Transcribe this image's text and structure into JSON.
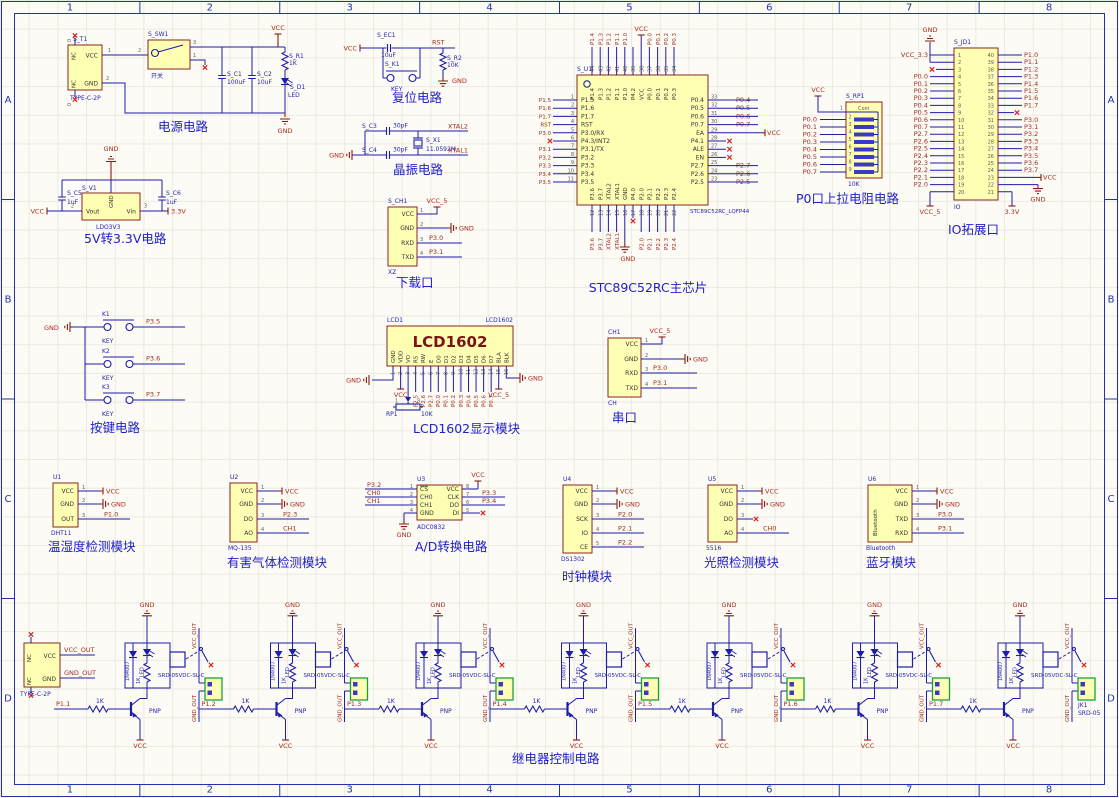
{
  "sheet": {
    "zone_columns": [
      "1",
      "2",
      "3",
      "4",
      "5",
      "6",
      "7",
      "8"
    ],
    "zone_rows": [
      "A",
      "B",
      "C",
      "D"
    ],
    "colors": {
      "component_fill": "#FFFFB4",
      "component_border": "#7A1010",
      "wire": "#1D1DA8",
      "net_label": "#9E2A20",
      "power_label": "#A82A1E",
      "annotation_blue": "#1F1FB0",
      "title_blue": "#2020CC",
      "terminal_green": "#18A038",
      "nc_red": "#E02020",
      "background": "#FCFBF5"
    }
  },
  "blocks": {
    "power": {
      "title": "电源电路",
      "t1": {
        "refdes": "S_T1",
        "value": "TYPE-C-2P",
        "pin_vcc": "VCC",
        "pin_gnd": "GND",
        "pin_nc": "NC",
        "num_vcc": "1",
        "num_gnd": "2",
        "nc_num": "0"
      },
      "sw": {
        "refdes": "S_SW1",
        "value": "开关",
        "num_in": "2",
        "num_out": "3",
        "num_nc": "1"
      },
      "c1": {
        "refdes": "S_C1",
        "value": "100uF"
      },
      "c2": {
        "refdes": "S_C2",
        "value": "10uF"
      },
      "r1": {
        "refdes": "S_R1",
        "value": "1K"
      },
      "d1": {
        "refdes": "S_D1",
        "value": "LED"
      },
      "vcc": "VCC",
      "gnd": "GND"
    },
    "reset": {
      "title": "复位电路",
      "vcc": "VCC",
      "rst": "RST",
      "gnd": "GND",
      "ec1": {
        "refdes": "S_EC1",
        "value": "10uF"
      },
      "k1": {
        "refdes": "S_K1",
        "value": "KEY"
      },
      "r2": {
        "refdes": "S_R2",
        "value": "10K"
      }
    },
    "crystal": {
      "title": "晶振电路",
      "gnd": "GND",
      "xtal2": "XTAL2",
      "xtal1": "XTAL1",
      "c3": {
        "refdes": "S_C3",
        "value": "30pF"
      },
      "c4": {
        "refdes": "S_C4",
        "value": "30pF"
      },
      "x1": {
        "refdes": "S_X1",
        "value": "11.0592M"
      }
    },
    "ldo": {
      "title": "5V转3.3V电路",
      "vcc": "VCC",
      "gnd": "GND",
      "v33": "3.3V",
      "v1": {
        "refdes": "S_V1",
        "value": "LDO3V3",
        "pin_out": "Vout",
        "pin_gnd": "GND",
        "pin_in": "Vin",
        "num_out": "2",
        "num_in": "3"
      },
      "c5": {
        "refdes": "S_C5",
        "value": "1uF"
      },
      "c6": {
        "refdes": "S_C6",
        "value": "1uF"
      }
    },
    "download": {
      "title": "下载口",
      "refdes": "S_CH1",
      "value": "XZ",
      "pins": [
        {
          "name": "VCC",
          "num": "1",
          "net": "VCC_5"
        },
        {
          "name": "GND",
          "num": "2",
          "net": "GND"
        },
        {
          "name": "RXD",
          "num": "3",
          "net": "P3.0"
        },
        {
          "name": "TXD",
          "num": "4",
          "net": "P3.1"
        }
      ]
    },
    "serial": {
      "title": "串口",
      "refdes": "CH1",
      "value": "CH",
      "pins": [
        {
          "name": "VCC",
          "num": "1",
          "net": "VCC_5"
        },
        {
          "name": "GND",
          "num": "2",
          "net": "GND"
        },
        {
          "name": "RXD",
          "num": "3",
          "net": "P3.0"
        },
        {
          "name": "TXD",
          "num": "4",
          "net": "P3.1"
        }
      ]
    },
    "mcu": {
      "title": "STC89C52RC主芯片",
      "refdes": "S_U1",
      "value": "STC89C52RC_LQFP44",
      "gnd": "GND",
      "vcc": "VCC",
      "top_pins": [
        {
          "num": "44",
          "name": "P1.4",
          "net": "P1.4"
        },
        {
          "num": "43",
          "name": "P1.3",
          "net": "P1.3"
        },
        {
          "num": "42",
          "name": "P1.2",
          "net": "P1.2"
        },
        {
          "num": "41",
          "name": "P1.1",
          "net": "P1.1"
        },
        {
          "num": "40",
          "name": "P1.0",
          "net": "P1.0"
        },
        {
          "num": "39",
          "name": "P4.2",
          "net": ""
        },
        {
          "num": "38",
          "name": "VCC",
          "net": "VCC"
        },
        {
          "num": "37",
          "name": "P0.0",
          "net": "P0.0"
        },
        {
          "num": "36",
          "name": "P0.1",
          "net": "P0.1"
        },
        {
          "num": "35",
          "name": "P0.2",
          "net": "P0.2"
        },
        {
          "num": "34",
          "name": "P0.3",
          "net": "P0.3"
        }
      ],
      "left_pins": [
        {
          "num": "1",
          "name": "P1.5",
          "net": "P1.5"
        },
        {
          "num": "2",
          "name": "P1.6",
          "net": "P1.6"
        },
        {
          "num": "3",
          "name": "P1.7",
          "net": "P1.7"
        },
        {
          "num": "4",
          "name": "RST",
          "net": "RST"
        },
        {
          "num": "5",
          "name": "P3.0/RX",
          "net": "P3.0"
        },
        {
          "num": "6",
          "name": "P4.3/INT2",
          "net": ""
        },
        {
          "num": "7",
          "name": "P3.1/TX",
          "net": "P3.1"
        },
        {
          "num": "8",
          "name": "P3.2",
          "net": "P3.2"
        },
        {
          "num": "9",
          "name": "P3.3",
          "net": "P3.3"
        },
        {
          "num": "10",
          "name": "P3.4",
          "net": "P3.4"
        },
        {
          "num": "11",
          "name": "P3.5",
          "net": "P3.5"
        }
      ],
      "right_pins": [
        {
          "num": "33",
          "name": "P0.4",
          "net": "P0.4"
        },
        {
          "num": "32",
          "name": "P0.5",
          "net": "P0.5"
        },
        {
          "num": "31",
          "name": "P0.6",
          "net": "P0.6"
        },
        {
          "num": "30",
          "name": "P0.7",
          "net": "P0.7"
        },
        {
          "num": "29",
          "name": "EA",
          "net": "VCC"
        },
        {
          "num": "28",
          "name": "P4.1",
          "net": ""
        },
        {
          "num": "27",
          "name": "ALE",
          "net": ""
        },
        {
          "num": "26",
          "name": "EN",
          "net": ""
        },
        {
          "num": "25",
          "name": "P2.7",
          "net": "P2.7"
        },
        {
          "num": "24",
          "name": "P2.6",
          "net": "P2.6"
        },
        {
          "num": "23",
          "name": "P2.5",
          "net": "P2.5"
        }
      ],
      "bottom_pins": [
        {
          "num": "12",
          "name": "P3.6",
          "net": "P3.6"
        },
        {
          "num": "13",
          "name": "P3.7",
          "net": "P3.7"
        },
        {
          "num": "14",
          "name": "XTAL2",
          "net": "XTAL2"
        },
        {
          "num": "15",
          "name": "XTAL1",
          "net": "XTAL1"
        },
        {
          "num": "16",
          "name": "GND",
          "net": "GND"
        },
        {
          "num": "17",
          "name": "P4.0",
          "net": ""
        },
        {
          "num": "18",
          "name": "P2.0",
          "net": "P2.0"
        },
        {
          "num": "19",
          "name": "P2.1",
          "net": "P2.1"
        },
        {
          "num": "20",
          "name": "P2.2",
          "net": "P2.2"
        },
        {
          "num": "21",
          "name": "P2.3",
          "net": "P2.3"
        },
        {
          "num": "22",
          "name": "P2.4",
          "net": "P2.4"
        }
      ]
    },
    "pullup": {
      "title": "P0口上拉电阻电路",
      "refdes": "S_RP1",
      "value": "10K",
      "com": "Com",
      "vcc": "VCC",
      "nums": [
        "1",
        "2",
        "3",
        "4",
        "5",
        "6",
        "7",
        "8",
        "9"
      ],
      "nets": [
        "P0.0",
        "P0.1",
        "P0.2",
        "P0.3",
        "P0.4",
        "P0.5",
        "P0.6",
        "P0.7"
      ]
    },
    "io": {
      "title": "IO拓展口",
      "refdes": "S_JD1",
      "value": "IO",
      "left": [
        {
          "num": "1",
          "net": "VCC_3.3"
        },
        {
          "num": "2",
          "net": "GND"
        },
        {
          "num": "3",
          "net": ""
        },
        {
          "num": "4",
          "net": "P0.0"
        },
        {
          "num": "5",
          "net": "P0.1"
        },
        {
          "num": "6",
          "net": "P0.2"
        },
        {
          "num": "7",
          "net": "P0.3"
        },
        {
          "num": "8",
          "net": "P0.4"
        },
        {
          "num": "9",
          "net": "P0.5"
        },
        {
          "num": "10",
          "net": "P0.6"
        },
        {
          "num": "11",
          "net": "P0.7"
        },
        {
          "num": "12",
          "net": "P2.7"
        },
        {
          "num": "13",
          "net": "P2.6"
        },
        {
          "num": "14",
          "net": "P2.5"
        },
        {
          "num": "15",
          "net": "P2.4"
        },
        {
          "num": "16",
          "net": "P2.3"
        },
        {
          "num": "17",
          "net": "P2.2"
        },
        {
          "num": "18",
          "net": "P2.1"
        },
        {
          "num": "19",
          "net": "P2.0"
        },
        {
          "num": "20",
          "net": "VCC_5"
        }
      ],
      "right": [
        {
          "num": "40",
          "net": "P1.0"
        },
        {
          "num": "39",
          "net": "P1.1"
        },
        {
          "num": "38",
          "net": "P1.2"
        },
        {
          "num": "37",
          "net": "P1.3"
        },
        {
          "num": "36",
          "net": "P1.4"
        },
        {
          "num": "35",
          "net": "P1.5"
        },
        {
          "num": "34",
          "net": "P1.6"
        },
        {
          "num": "33",
          "net": "P1.7"
        },
        {
          "num": "32",
          "net": ""
        },
        {
          "num": "31",
          "net": "P3.0"
        },
        {
          "num": "30",
          "net": "P3.1"
        },
        {
          "num": "29",
          "net": "P3.2"
        },
        {
          "num": "28",
          "net": "P3.3"
        },
        {
          "num": "27",
          "net": "P3.4"
        },
        {
          "num": "26",
          "net": "P3.5"
        },
        {
          "num": "25",
          "net": "P3.6"
        },
        {
          "num": "24",
          "net": "P3.7"
        },
        {
          "num": "23",
          "net": "VCC"
        },
        {
          "num": "22",
          "net": "GND"
        },
        {
          "num": "21",
          "net": "3.3V"
        }
      ]
    },
    "keys": {
      "title": "按键电路",
      "gnd": "GND",
      "items": [
        {
          "refdes": "K1",
          "value": "KEY",
          "net": "P3.5"
        },
        {
          "refdes": "K2",
          "value": "KEY",
          "net": "P3.6"
        },
        {
          "refdes": "K3",
          "value": "KEY",
          "net": "P3.7"
        }
      ]
    },
    "lcd": {
      "title": "LCD1602显示模块",
      "refdes": "LCD1",
      "value": "LCD1602",
      "display": "LCD1602",
      "pins": [
        "GND",
        "VDD",
        "VO",
        "RS",
        "RW",
        "E",
        "D0",
        "D1",
        "D2",
        "D3",
        "D4",
        "D5",
        "D6",
        "D7",
        "BLA",
        "BLK"
      ],
      "numbers": [
        "1",
        "2",
        "3",
        "4",
        "5",
        "6",
        "7",
        "8",
        "9",
        "10",
        "11",
        "12",
        "13",
        "14",
        "15",
        "16"
      ],
      "wire_nets": [
        "P2.5",
        "P2.6",
        "P2.7",
        "P0.0",
        "P0.1",
        "P0.2",
        "P0.3",
        "P0.4",
        "P0.5",
        "P0.6",
        "P0.7"
      ],
      "pot": {
        "refdes": "RP1",
        "value": "10K",
        "n1": "1",
        "n3": "3"
      },
      "vcc": "VCC",
      "vcc5": "VCC_5",
      "gnd": "GND"
    },
    "dht": {
      "title": "温湿度检测模块",
      "refdes": "U1",
      "value": "DHT11",
      "pins": [
        {
          "name": "VCC",
          "num": "1",
          "net": "VCC"
        },
        {
          "name": "GND",
          "num": "2",
          "net": "GND"
        },
        {
          "name": "OUT",
          "num": "3",
          "net": "P1.0"
        }
      ]
    },
    "gas": {
      "title": "有害气体检测模块",
      "refdes": "U2",
      "value": "MQ-135",
      "pins": [
        {
          "name": "VCC",
          "num": "1",
          "net": "VCC"
        },
        {
          "name": "GND",
          "num": "2",
          "net": "GND"
        },
        {
          "name": "DO",
          "num": "3",
          "net": "P2.3"
        },
        {
          "name": "AO",
          "num": "4",
          "net": "CH1"
        }
      ]
    },
    "adc": {
      "title": "A/D转换电路",
      "refdes": "U3",
      "value": "ADC0832",
      "left": [
        {
          "name": "CS",
          "num": "1",
          "net": "P3.2"
        },
        {
          "name": "CH0",
          "num": "2",
          "net": "CH0"
        },
        {
          "name": "CH1",
          "num": "3",
          "net": "CH1"
        },
        {
          "name": "GND",
          "num": "4",
          "net": "GND"
        }
      ],
      "right": [
        {
          "name": "VCC",
          "num": "8",
          "net": "VCC"
        },
        {
          "name": "CLK",
          "num": "7",
          "net": "P3.3"
        },
        {
          "name": "DO",
          "num": "6",
          "net": "P3.4"
        },
        {
          "name": "DI",
          "num": "5",
          "net": ""
        }
      ]
    },
    "rtc": {
      "title": "时钟模块",
      "refdes": "U4",
      "value": "DS1302",
      "pins": [
        {
          "name": "VCC",
          "num": "1",
          "net": "VCC"
        },
        {
          "name": "GND",
          "num": "2",
          "net": "GND"
        },
        {
          "name": "SCK",
          "num": "3",
          "net": "P2.0"
        },
        {
          "name": "IO",
          "num": "4",
          "net": "P2.1"
        },
        {
          "name": "CE",
          "num": "5",
          "net": "P2.2"
        }
      ]
    },
    "light": {
      "title": "光照检测模块",
      "refdes": "U5",
      "value": "5516",
      "pins": [
        {
          "name": "VCC",
          "num": "1",
          "net": "VCC"
        },
        {
          "name": "GND",
          "num": "2",
          "net": "GND"
        },
        {
          "name": "DO",
          "num": "3",
          "net": ""
        },
        {
          "name": "AO",
          "num": "4",
          "net": "CH0"
        }
      ]
    },
    "bt": {
      "title": "蓝牙模块",
      "refdes": "U6",
      "value": "Bluetooth",
      "inner": "Bluetooth",
      "pins": [
        {
          "name": "VCC",
          "num": "1",
          "net": "VCC"
        },
        {
          "name": "GND",
          "num": "2",
          "net": "GND"
        },
        {
          "name": "TXD",
          "num": "3",
          "net": "P3.0"
        },
        {
          "name": "RXD",
          "num": "4",
          "net": "P3.1"
        }
      ]
    },
    "relay": {
      "title": "继电器控制电路",
      "inputs": [
        "P1.1",
        "P1.2",
        "P1.3",
        "P1.4",
        "P1.5",
        "P1.6",
        "P1.7"
      ],
      "base_res": "1K",
      "pnp": "PNP",
      "diode": "1N4007",
      "led": "LED",
      "coil_res": "1K",
      "relay_model": "SRD-05VDC-SL-C",
      "gnd": "GND",
      "vcc": "VCC",
      "vcc_out": "VCC_OUT",
      "gnd_out": "GND_OUT",
      "connector": {
        "value": "TYPE-C-2P",
        "pin_vcc": "VCC",
        "pin_gnd": "GND",
        "pin_nc": "NC"
      },
      "terminal": {
        "refdes": "JK1",
        "value": "SRD-05"
      }
    }
  }
}
